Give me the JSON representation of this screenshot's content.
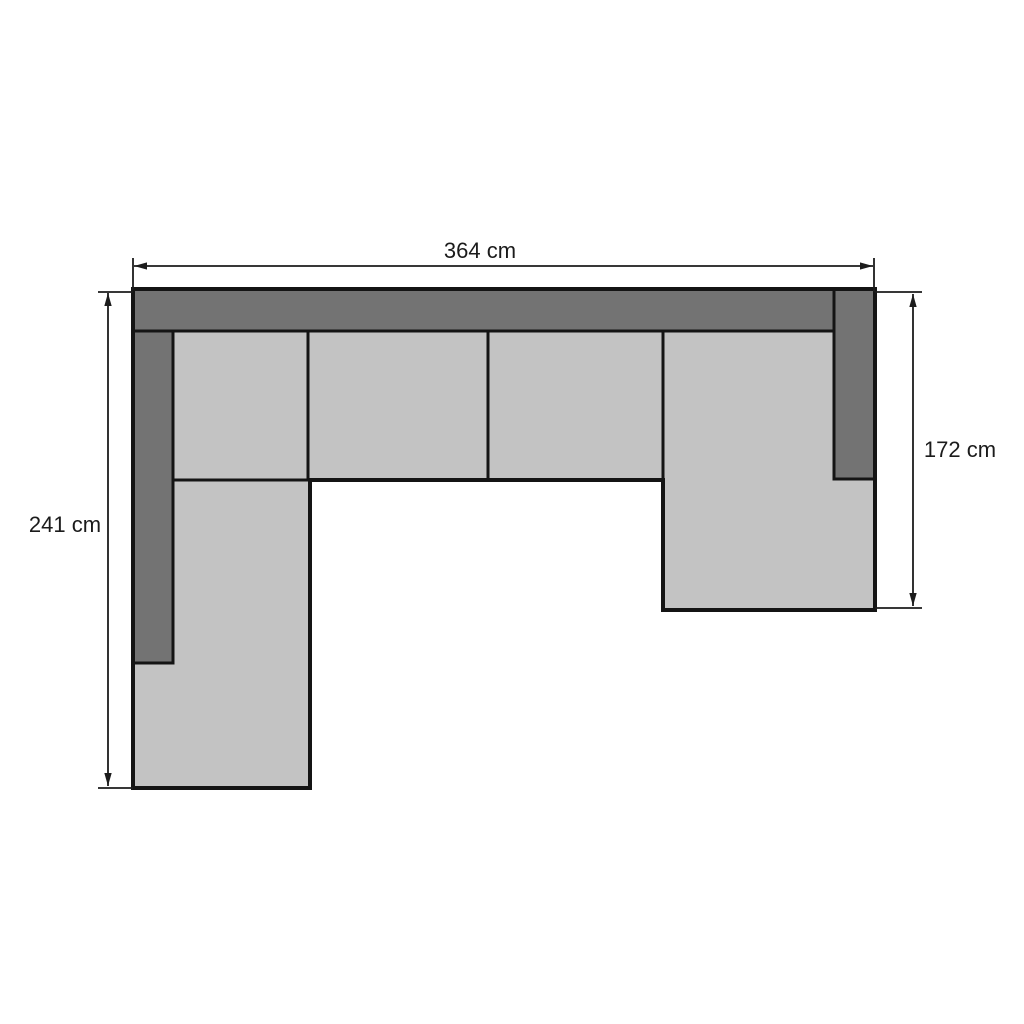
{
  "diagram": {
    "kind": "sectional-sofa-top-view-floorplan",
    "dimensions": {
      "width_label": "364 cm",
      "height_left_label": "241 cm",
      "height_right_label": "172 cm"
    },
    "colors": {
      "frame": "#737373",
      "cushion": "#c3c3c3",
      "outline": "#141414",
      "dimension": "#1c1c1c",
      "background": "#ffffff"
    }
  }
}
